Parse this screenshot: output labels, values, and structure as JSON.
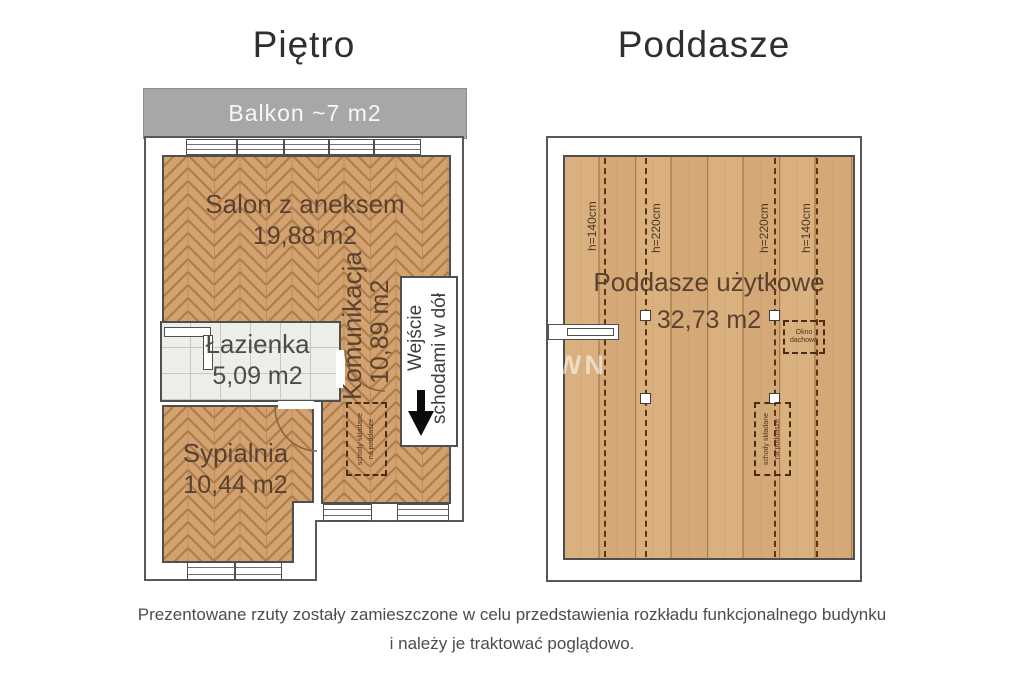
{
  "titles": {
    "left": "Piętro",
    "right": "Poddasze"
  },
  "floor1": {
    "balcony_label": "Balkon ~7 m2",
    "salon": {
      "name": "Salon z aneksem",
      "area": "19,88 m2"
    },
    "lazienka": {
      "name": "Łazienka",
      "area": "5,09 m2"
    },
    "komunikacja": {
      "name": "Komunikacja",
      "area": "10,89 m2"
    },
    "sypialnia": {
      "name": "Sypialnia",
      "area": "10,44 m2"
    },
    "entrance": {
      "line1": "Wejście",
      "line2": "schodami w dół"
    },
    "folding_stairs": {
      "line1": "schody składane",
      "line2": "na poddasze"
    }
  },
  "attic": {
    "room": {
      "name": "Poddasze użytkowe",
      "area": "32,73 m2"
    },
    "heights": [
      "h=140cm",
      "h=220cm",
      "h=220cm",
      "h=140cm"
    ],
    "roof_window": {
      "line1": "Okno",
      "line2": "dachowe"
    },
    "folding_stairs": {
      "line1": "schody składane",
      "line2": "na poddasze"
    },
    "watermark": "WN"
  },
  "disclaimer": {
    "line1": "Prezentowane rzuty zostały zamieszczone w celu przedstawienia rozkładu funkcjonalnego budynku",
    "line2": "i należy je traktować poglądowo."
  },
  "colors": {
    "balcony_gray": "#a7a7a7",
    "wall": "#4f4f4f",
    "wood_parquet": "#d2a271",
    "wood_planks": "#dab07f",
    "tiles": "#eceee9",
    "dashed_brown": "#5c3315",
    "label_brown": "#5a4130",
    "arrow_black": "#0b0b0b"
  }
}
